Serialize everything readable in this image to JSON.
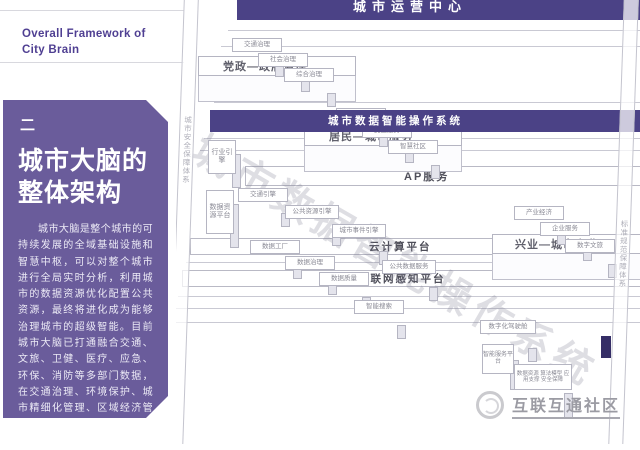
{
  "header": {
    "title_en_line1": "Overall Framework of",
    "title_en_line2": "City Brain"
  },
  "sidebar": {
    "section_marker": "二",
    "title_line1": "城市大脑的",
    "title_line2": "整体架构",
    "body": "城市大脑是整个城市的可持续发展的全域基础设施和智慧中枢，可以对整个城市进行全局实时分析，利用城市的数据资源优化配置公共资源，最终将进化成为能够治理城市的超级智能。目前城市大脑已打通融合交通、文旅、卫健、医疗、应急、环保、消防等多部门数据，在交通治理、环境保护、城市精细化管理、区域经济管理等领域进行了许多成功探索。"
  },
  "diagram": {
    "watermark": "城市数据智能操作系统",
    "pillars": {
      "left": "城市安全保障体系",
      "right": "标准规范保障体系"
    },
    "bars": {
      "ops": "城市运营中心",
      "os": "城市数据智能操作系统",
      "api": "AP服务",
      "cloud": "云计算平台",
      "iot": "城市物联网感知平台"
    },
    "platforms": [
      {
        "label": "党政—政府治理",
        "boxes": [
          "交通治理",
          "社会治理",
          "综合治理"
        ]
      },
      {
        "label": "居民—城市服务",
        "boxes": [
          "公共服务",
          "民生服务",
          "智慧社区"
        ]
      },
      {
        "label": "兴业—城市产业",
        "boxes": [
          "产业经济",
          "企业服务",
          "数字文旅"
        ]
      }
    ],
    "engines": [
      "交通引擎",
      "公共资源引擎",
      "城市事件引擎",
      "公共数据服务",
      "数据工厂",
      "数据治理",
      "数据质量",
      "智能搜索",
      "数字化驾驶舱"
    ],
    "tall": [
      "行业引擎",
      "数据资源平台",
      "智能服务平台"
    ],
    "detail": "数据资源 算法模型 应用支撑 安全保障"
  },
  "footer": {
    "community": "互联互通社区"
  },
  "colors": {
    "card_purple": "#6a5c9b",
    "bar_purple": "#4b4286",
    "accent_text": "#4f3f92"
  }
}
